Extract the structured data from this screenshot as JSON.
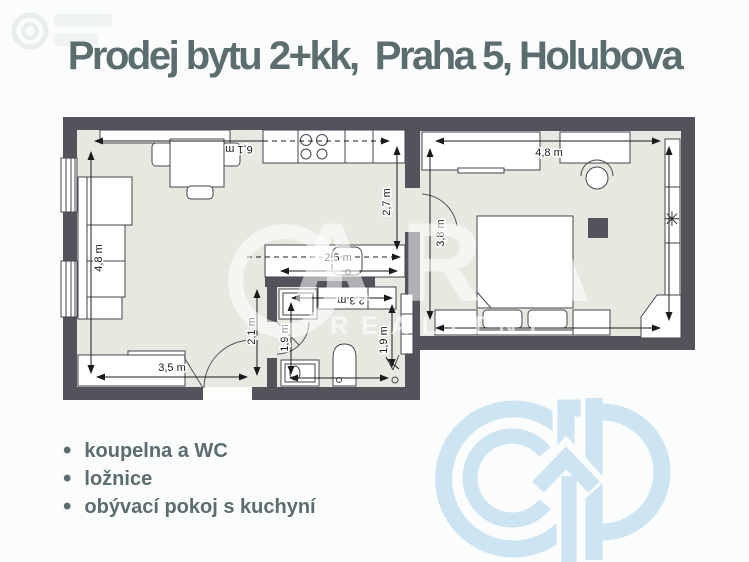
{
  "header": {
    "title": "Prodej bytu 2+kk,  Praha 5, Holubova"
  },
  "features": {
    "items": [
      "koupelna a WC",
      "ložnice",
      "obývací pokoj s kuchyní"
    ]
  },
  "floor_plan": {
    "dimensions": {
      "living_height": "4,8 m",
      "living_width": "6,1 m",
      "kitchen_depth": "2,7 m",
      "island_width": "2,5 m",
      "hall_width": "2,3 m",
      "entry_height": "2,1 m",
      "bath_height_left": "1,9 m",
      "bath_height_right": "1,9 m",
      "living_bottom_width": "3,5 m",
      "bedroom_width": "4,8 m",
      "bedroom_height": "3,8 m"
    },
    "colors": {
      "wall": "#53535b",
      "floor": "#e8e8e1"
    }
  },
  "watermark": {
    "letters": "ARA",
    "word": "REALITNÍ"
  },
  "icons": {
    "bullet-icon": "•",
    "plant-icon": "✳"
  },
  "brand": {
    "accent_text_color": "#5c6d6f",
    "logo_color": "#cde4f2"
  }
}
